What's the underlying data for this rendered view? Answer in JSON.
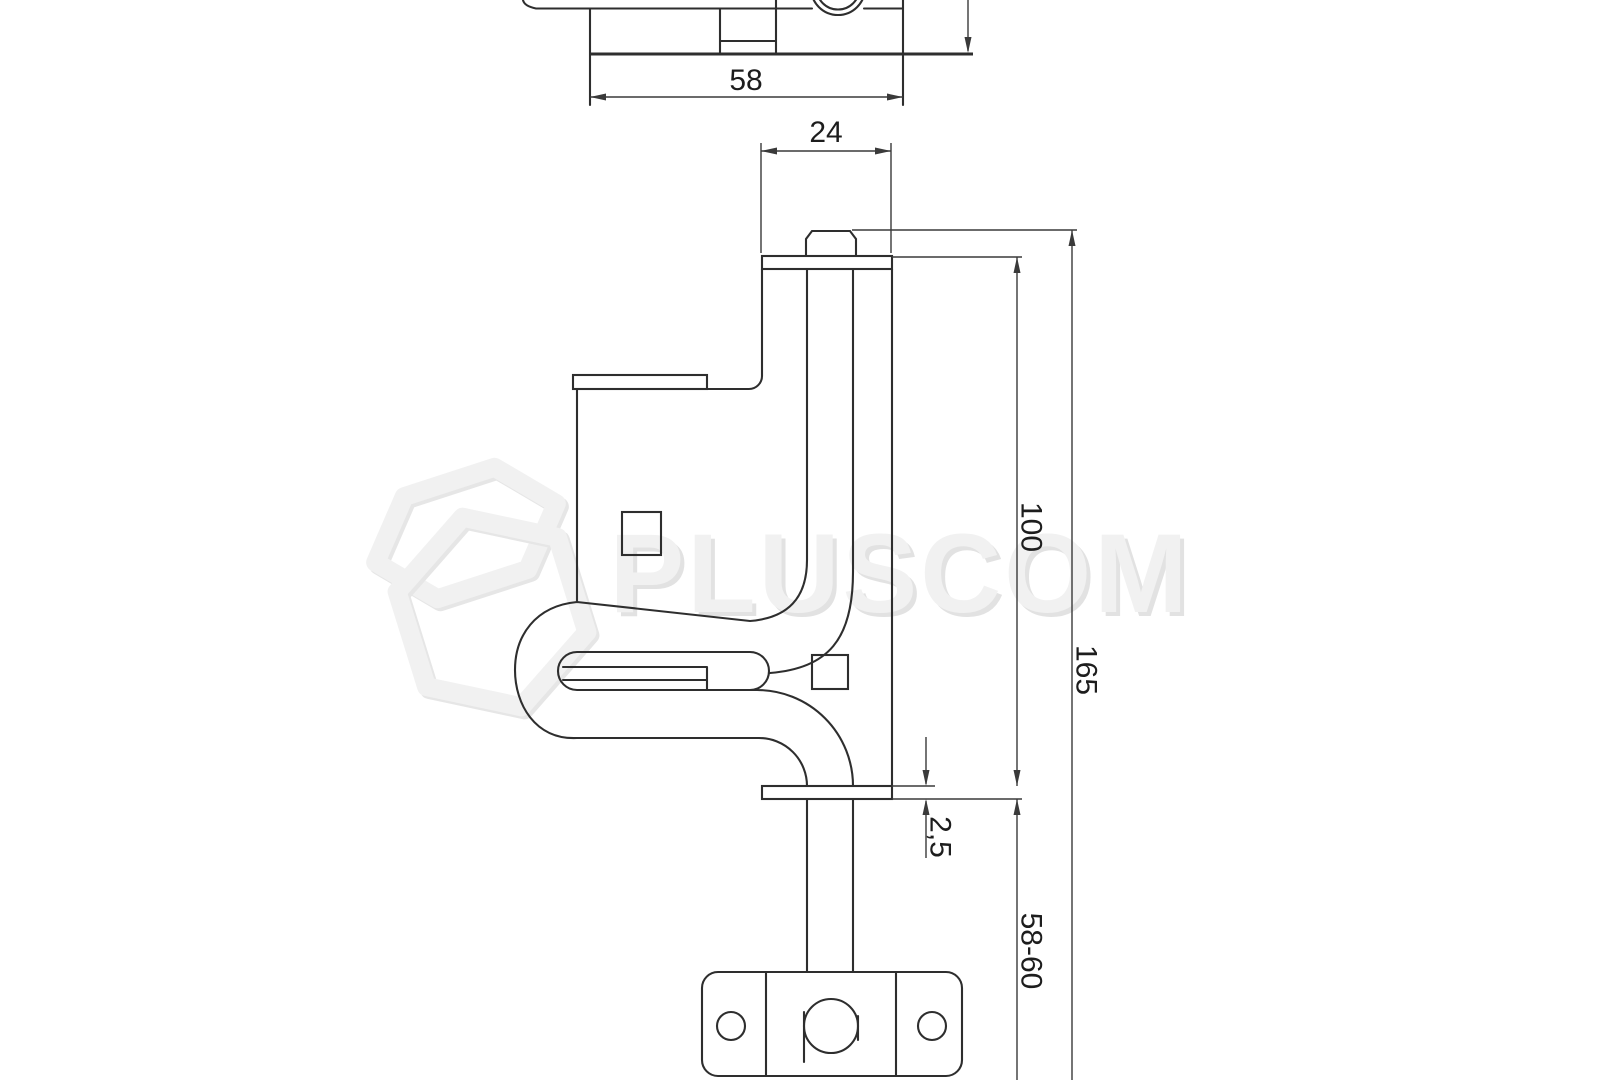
{
  "watermark": {
    "brand": "PLUSCOM"
  },
  "dimensions": {
    "top_view_width": "58",
    "guide_bracket_width": "24",
    "bolt_guide_length": "100",
    "overall_length": "165",
    "flange_thickness": "2,5",
    "rod_extension": "58-60"
  },
  "colors": {
    "background": "#ffffff",
    "outline": "#2e2e2e",
    "dimension": "#3a3a3a",
    "watermark": "#f1f1f1",
    "watermark_shadow": "#e2e2e2"
  }
}
